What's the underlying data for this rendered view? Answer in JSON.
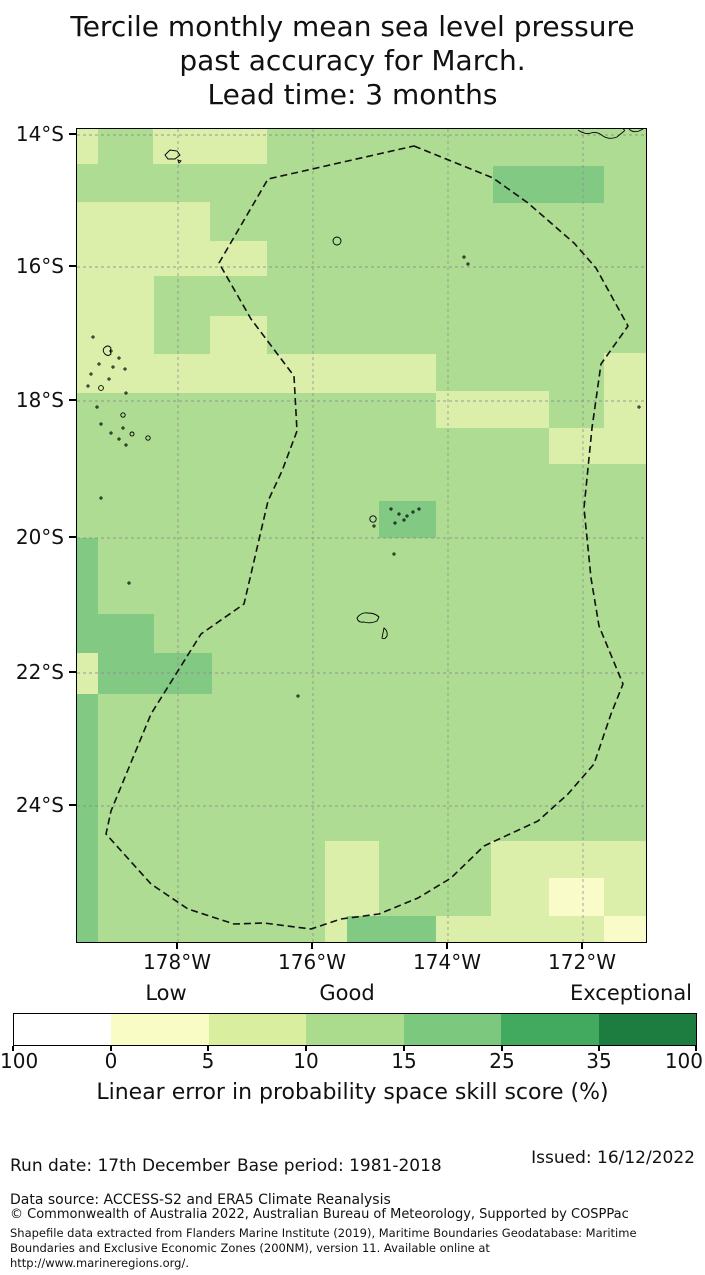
{
  "title": {
    "lines": [
      "Tercile monthly mean sea level pressure",
      "past accuracy for March.",
      "Lead time: 3 months"
    ]
  },
  "map": {
    "width": 569,
    "height": 813,
    "colors": {
      "base": "#aedc92",
      "pale": "#dcefaa",
      "yellow": "#f9fbc9",
      "dark": "#82c983",
      "grid": "#8c8c8c",
      "coast": "#000000",
      "eez": "#111111"
    },
    "patches": [
      {
        "x": 0,
        "y": 0,
        "w": 21,
        "h": 35,
        "c": "pale"
      },
      {
        "x": 76,
        "y": 0,
        "w": 114,
        "h": 35,
        "c": "pale"
      },
      {
        "x": 0,
        "y": 73,
        "w": 133,
        "h": 74,
        "c": "pale"
      },
      {
        "x": 133,
        "y": 112,
        "w": 57,
        "h": 35,
        "c": "pale"
      },
      {
        "x": 0,
        "y": 147,
        "w": 77,
        "h": 117,
        "c": "pale"
      },
      {
        "x": 133,
        "y": 187,
        "w": 57,
        "h": 38,
        "c": "pale"
      },
      {
        "x": 0,
        "y": 225,
        "w": 359,
        "h": 39,
        "c": "pale"
      },
      {
        "x": 359,
        "y": 262,
        "w": 113,
        "h": 37,
        "c": "pale"
      },
      {
        "x": 527,
        "y": 224,
        "w": 42,
        "h": 75,
        "c": "pale"
      },
      {
        "x": 472,
        "y": 299,
        "w": 97,
        "h": 36,
        "c": "pale"
      },
      {
        "x": 0,
        "y": 524,
        "w": 21,
        "h": 41,
        "c": "pale"
      },
      {
        "x": 248,
        "y": 712,
        "w": 54,
        "h": 75,
        "c": "pale"
      },
      {
        "x": 248,
        "y": 787,
        "w": 22,
        "h": 26,
        "c": "pale"
      },
      {
        "x": 414,
        "y": 712,
        "w": 155,
        "h": 37,
        "c": "pale"
      },
      {
        "x": 414,
        "y": 749,
        "w": 58,
        "h": 38,
        "c": "pale"
      },
      {
        "x": 527,
        "y": 749,
        "w": 42,
        "h": 38,
        "c": "pale"
      },
      {
        "x": 359,
        "y": 787,
        "w": 168,
        "h": 26,
        "c": "pale"
      },
      {
        "x": 472,
        "y": 749,
        "w": 55,
        "h": 38,
        "c": "yellow"
      },
      {
        "x": 527,
        "y": 787,
        "w": 42,
        "h": 26,
        "c": "yellow"
      },
      {
        "x": 416,
        "y": 37,
        "w": 111,
        "h": 37,
        "c": "dark"
      },
      {
        "x": 0,
        "y": 409,
        "w": 21,
        "h": 76,
        "c": "dark"
      },
      {
        "x": 0,
        "y": 485,
        "w": 77,
        "h": 39,
        "c": "dark"
      },
      {
        "x": 21,
        "y": 524,
        "w": 114,
        "h": 41,
        "c": "dark"
      },
      {
        "x": 0,
        "y": 565,
        "w": 21,
        "h": 248,
        "c": "dark"
      },
      {
        "x": 302,
        "y": 372,
        "w": 57,
        "h": 37,
        "c": "dark"
      },
      {
        "x": 270,
        "y": 787,
        "w": 89,
        "h": 26,
        "c": "dark"
      }
    ],
    "gridlines": {
      "v": [
        101,
        236,
        371,
        506
      ],
      "h": [
        6,
        138,
        272,
        409,
        544,
        677
      ]
    },
    "eez_points": [
      [
        337,
        17
      ],
      [
        416,
        49
      ],
      [
        451,
        74
      ],
      [
        497,
        114
      ],
      [
        519,
        139
      ],
      [
        551,
        197
      ],
      [
        524,
        235
      ],
      [
        515,
        299
      ],
      [
        507,
        379
      ],
      [
        514,
        449
      ],
      [
        522,
        497
      ],
      [
        546,
        555
      ],
      [
        534,
        585
      ],
      [
        517,
        635
      ],
      [
        491,
        665
      ],
      [
        461,
        692
      ],
      [
        407,
        717
      ],
      [
        374,
        749
      ],
      [
        341,
        769
      ],
      [
        302,
        785
      ],
      [
        264,
        790
      ],
      [
        234,
        800
      ],
      [
        187,
        794
      ],
      [
        157,
        795
      ],
      [
        111,
        780
      ],
      [
        74,
        755
      ],
      [
        47,
        725
      ],
      [
        29,
        705
      ],
      [
        34,
        682
      ],
      [
        74,
        585
      ],
      [
        124,
        505
      ],
      [
        167,
        475
      ],
      [
        191,
        372
      ],
      [
        205,
        342
      ],
      [
        220,
        302
      ],
      [
        217,
        247
      ],
      [
        174,
        190
      ],
      [
        142,
        134
      ],
      [
        191,
        50
      ]
    ],
    "islands": {
      "paths": [
        {
          "name": "coastline-northeast",
          "d": "M501,1 Q508,6 514,4 Q520,2 526,7 Q532,11 540,8 L546,3 Q549,1 546,0"
        },
        {
          "name": "coastline-northeast-2",
          "d": "M552,0 Q556,4 562,2 L566,0"
        },
        {
          "name": "island-northwest",
          "d": "M88,26 L93,21 L100,22 L103,26 L98,30 L91,30 Z"
        },
        {
          "name": "island-northwest-2",
          "d": "M101,31 l3,1 l-2,2 z"
        },
        {
          "name": "island-tongatapu",
          "d": "M280,489 Q284,483 291,484 Q298,484 302,488 L300,492 Q293,495 287,493 Q281,494 280,489 Z"
        },
        {
          "name": "island-crescent",
          "d": "M307,499 Q311,502 310,507 Q308,511 305,509 Q306,504 307,499 Z"
        },
        {
          "name": "island-lau-squiggle",
          "d": "M27,219 q4,-4 7,0 q-1,3 0,6 q-3,3 -6,0 q-3,-3 -1,-6 z"
        }
      ],
      "circles": [
        {
          "cx": 260,
          "cy": 112,
          "r": 4
        },
        {
          "cx": 296,
          "cy": 390,
          "r": 3.2
        },
        {
          "cx": 24,
          "cy": 259,
          "r": 2.4
        },
        {
          "cx": 46,
          "cy": 286,
          "r": 2.2
        },
        {
          "cx": 55,
          "cy": 305,
          "r": 2
        },
        {
          "cx": 71,
          "cy": 309,
          "r": 2.2
        }
      ],
      "dots": [
        [
          16,
          208
        ],
        [
          34,
          222
        ],
        [
          42,
          229
        ],
        [
          22,
          235
        ],
        [
          36,
          238
        ],
        [
          48,
          240
        ],
        [
          14,
          245
        ],
        [
          32,
          250
        ],
        [
          11,
          257
        ],
        [
          49,
          264
        ],
        [
          20,
          278
        ],
        [
          24,
          295
        ],
        [
          46,
          299
        ],
        [
          34,
          304
        ],
        [
          42,
          310
        ],
        [
          49,
          316
        ],
        [
          24,
          369
        ],
        [
          52,
          454
        ],
        [
          221,
          567
        ],
        [
          562,
          278
        ],
        [
          387,
          128
        ],
        [
          391,
          135
        ],
        [
          314,
          380
        ],
        [
          322,
          385
        ],
        [
          330,
          387
        ],
        [
          336,
          383
        ],
        [
          327,
          391
        ],
        [
          318,
          394
        ],
        [
          342,
          380
        ],
        [
          297,
          397
        ],
        [
          317,
          425
        ]
      ]
    },
    "lat_ticks": [
      {
        "label": "14°S",
        "y": 6
      },
      {
        "label": "16°S",
        "y": 138
      },
      {
        "label": "18°S",
        "y": 272
      },
      {
        "label": "20°S",
        "y": 409
      },
      {
        "label": "22°S",
        "y": 544
      },
      {
        "label": "24°S",
        "y": 677
      }
    ],
    "lon_ticks": [
      {
        "label": "178°W",
        "x": 101
      },
      {
        "label": "176°W",
        "x": 236
      },
      {
        "label": "174°W",
        "x": 371
      },
      {
        "label": "172°W",
        "x": 506
      }
    ]
  },
  "colorbar": {
    "category_labels": [
      {
        "text": "Low",
        "x": 166
      },
      {
        "text": "Good",
        "x": 347
      },
      {
        "text": "Exceptional",
        "x": 631
      }
    ],
    "segment_colors": [
      "#ffffff",
      "#f9fcc5",
      "#d9ee9f",
      "#abdb8d",
      "#7cc87e",
      "#41aa5e",
      "#1d7c3f"
    ],
    "ticks": [
      {
        "label": "100",
        "x": 0,
        "align": "left"
      },
      {
        "label": "0",
        "x": 111,
        "align": "center"
      },
      {
        "label": "5",
        "x": 208,
        "align": "center"
      },
      {
        "label": "10",
        "x": 306,
        "align": "center"
      },
      {
        "label": "15",
        "x": 404,
        "align": "center"
      },
      {
        "label": "25",
        "x": 502,
        "align": "center"
      },
      {
        "label": "35",
        "x": 599,
        "align": "center"
      },
      {
        "label": "100",
        "x": 703,
        "align": "right"
      }
    ],
    "axis_label": "Linear error in probability space skill score (%)"
  },
  "footer": {
    "run_date": "Run date: 17th December",
    "base_period": "Base period: 1981-2018",
    "issued": "Issued: 16/12/2022",
    "data_source": "Data source: ACCESS-S2 and ERA5 Climate Reanalysis",
    "copyright_lines": [
      "© Commonwealth of Australia 2022, Australian Bureau of Meteorology, Supported by COSPPac",
      "Shapefile data extracted from Flanders Marine Institute (2019), Maritime Boundaries Geodatabase: Maritime",
      "Boundaries and Exclusive Economic Zones (200NM), version 11. Available online at",
      "http://www.marineregions.org/."
    ]
  },
  "chart_data": {
    "type": "heatmap",
    "title": "Tercile monthly mean sea level pressure past accuracy for March. Lead time: 3 months",
    "x_ticks": [
      "178°W",
      "176°W",
      "174°W",
      "172°W"
    ],
    "y_ticks": [
      "14°S",
      "16°S",
      "18°S",
      "20°S",
      "22°S",
      "24°S"
    ],
    "colorbar_label": "Linear error in probability space skill score (%)",
    "colorbar_boundaries": [
      -100,
      0,
      5,
      10,
      15,
      25,
      35,
      100
    ],
    "colorbar_categories": {
      "Low": "around 0-5",
      "Good": "around 10-15",
      "Exceptional": "35 and above"
    },
    "region_summary": {
      "dominant_skill_bin": "10-15",
      "pale_patches_bin": "5-10",
      "dark_patches_bin": "15-25",
      "palest_patches_bin": "0-5",
      "dark_patch_locations": [
        "~172.5-174°W 14.5-15°S",
        "west edge 20-26°S",
        "~177-178°W 21-22.5°S",
        "~174.3-175°W 19.5-20°S",
        "bottom edge ~174-175.5°W"
      ],
      "boundary": "dashed EEZ polygon around Fiji/Tonga region"
    }
  }
}
